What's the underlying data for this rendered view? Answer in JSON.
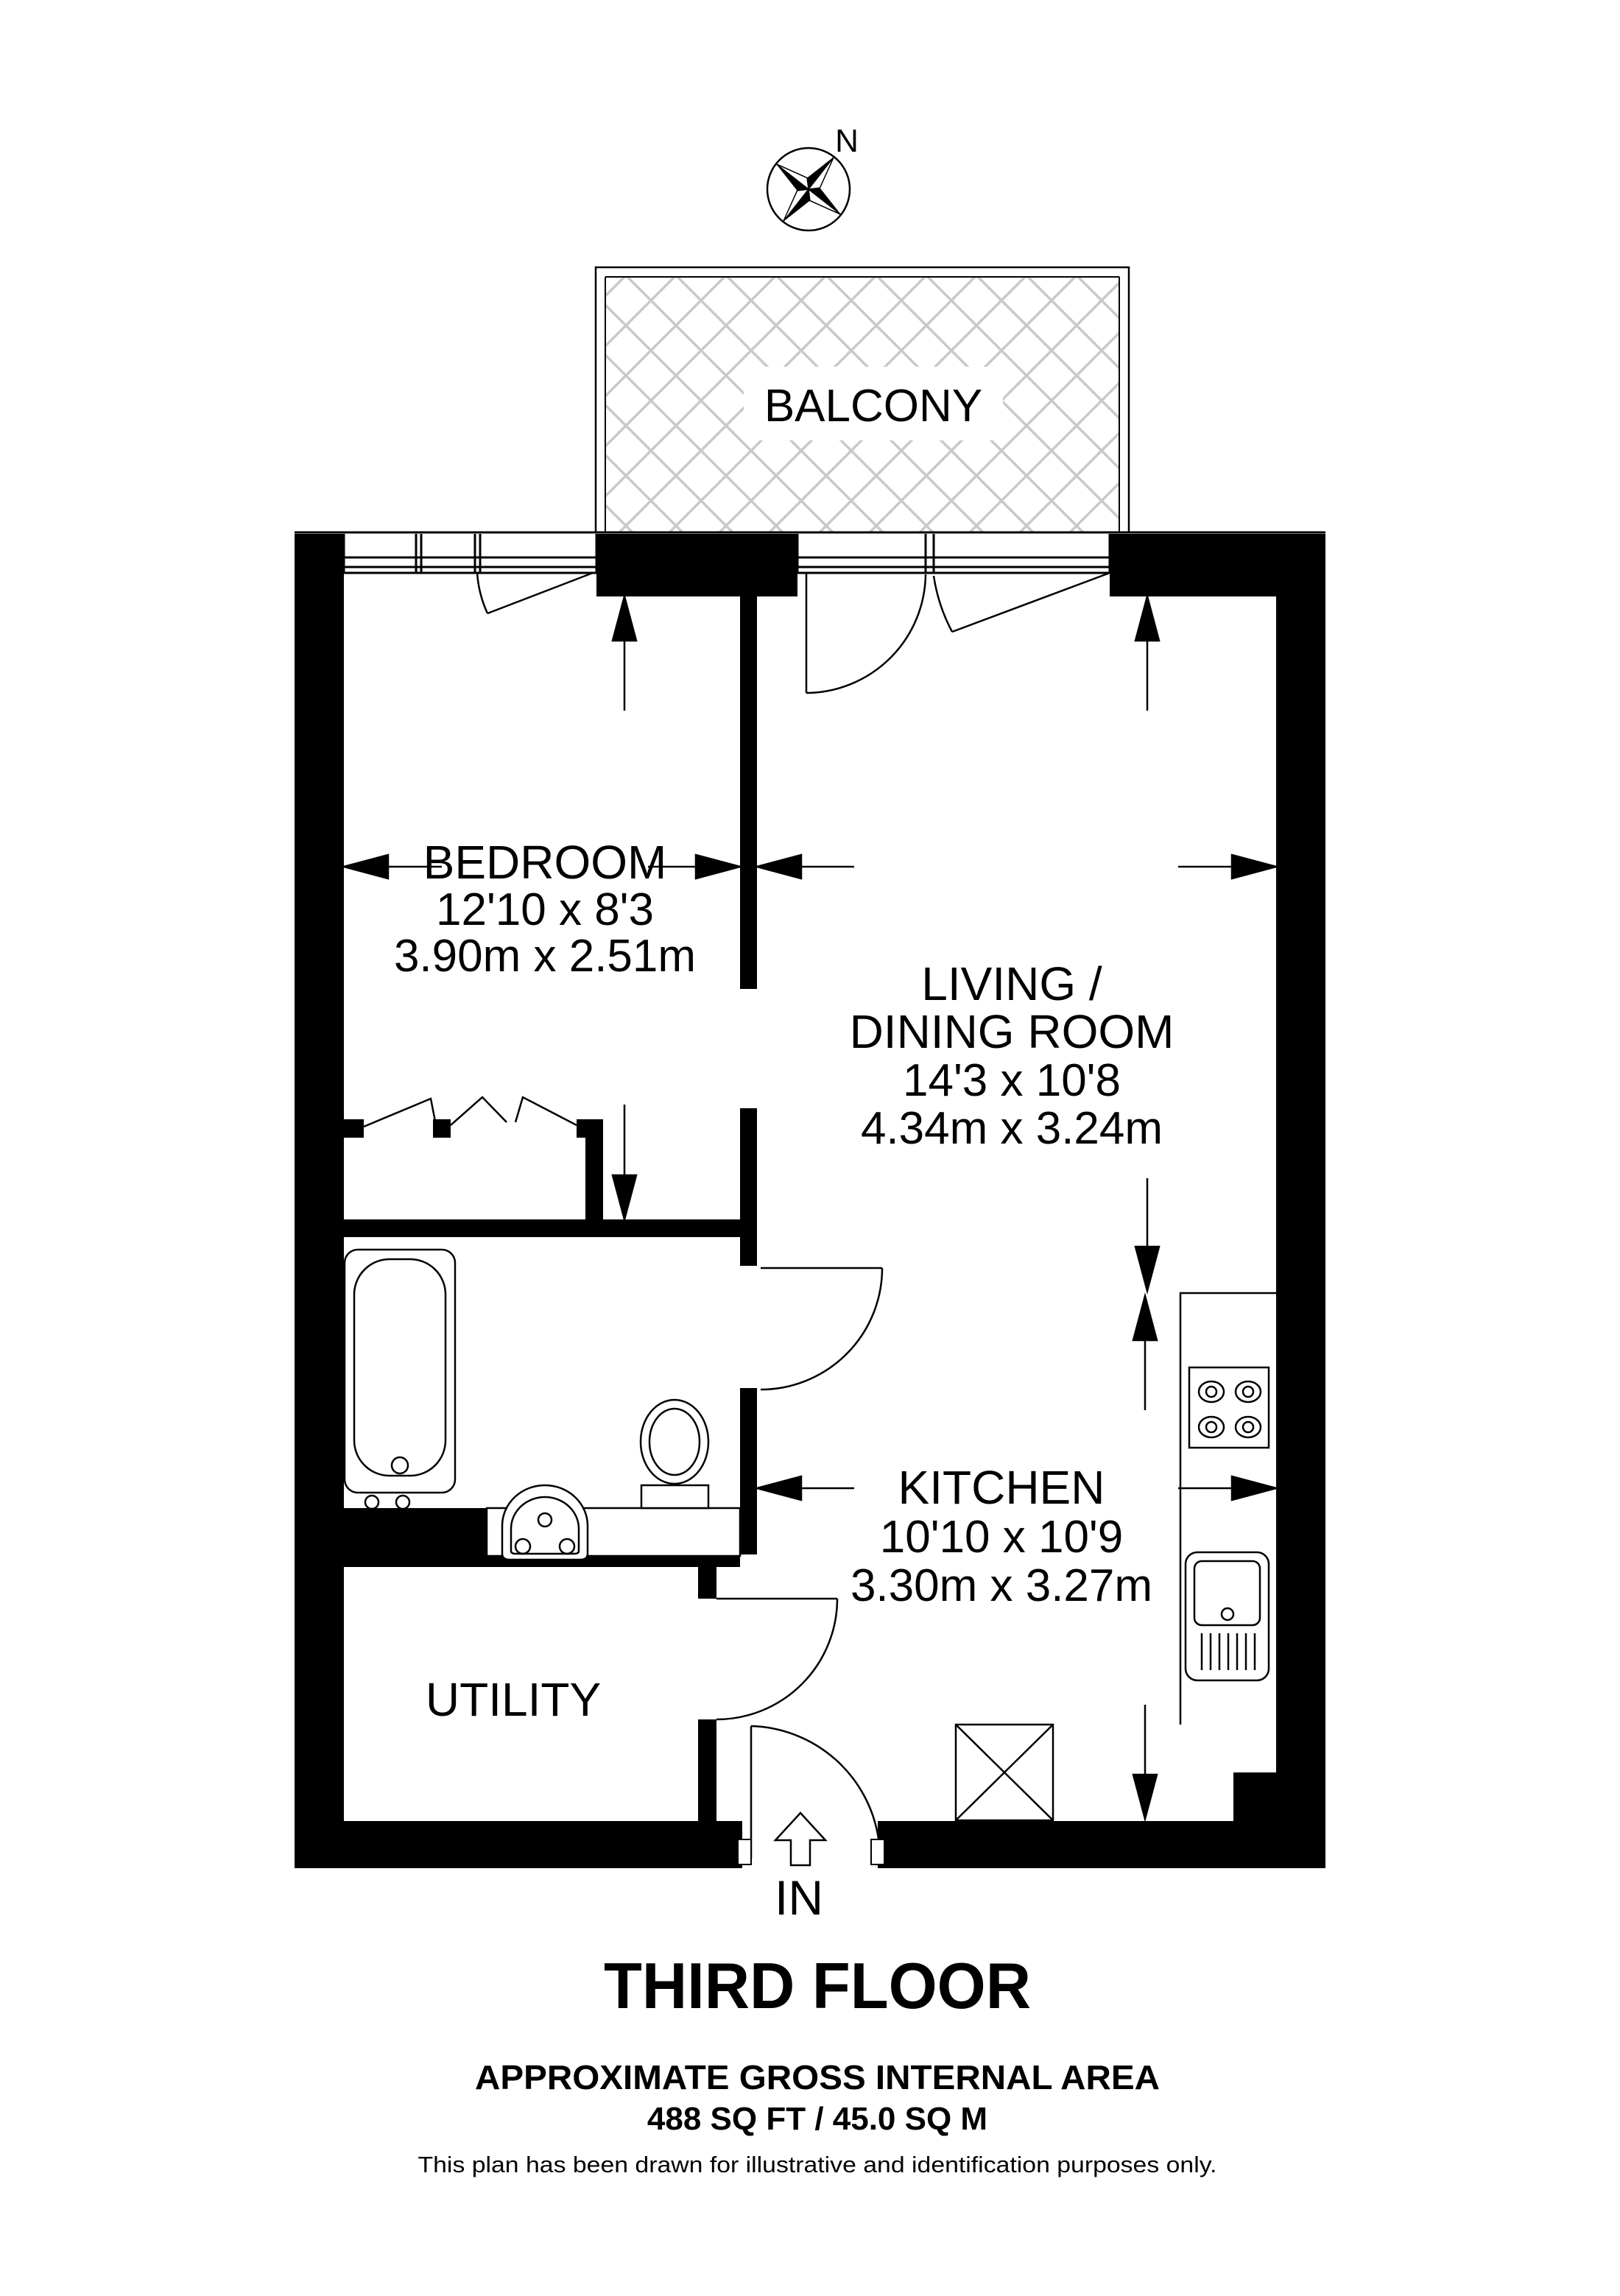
{
  "plan": {
    "compass": {
      "label": "N"
    },
    "balcony": {
      "label": "BALCONY"
    },
    "rooms": {
      "bedroom": {
        "name": "BEDROOM",
        "size_imperial": "12'10 x 8'3",
        "size_metric": "3.90m x 2.51m"
      },
      "living_dining": {
        "name_line1": "LIVING /",
        "name_line2": "DINING ROOM",
        "size_imperial": "14'3 x 10'8",
        "size_metric": "4.34m x 3.24m"
      },
      "kitchen": {
        "name": "KITCHEN",
        "size_imperial": "10'10 x 10'9",
        "size_metric": "3.30m x 3.27m"
      },
      "utility": {
        "name": "UTILITY"
      }
    },
    "entrance": {
      "label": "IN"
    }
  },
  "footer": {
    "floor_title": "THIRD FLOOR",
    "area_heading": "APPROXIMATE GROSS INTERNAL AREA",
    "area_value": "488 SQ FT / 45.0 SQ M",
    "disclaimer": "This plan has been drawn for illustrative and identification purposes only."
  },
  "colors": {
    "walls": "#000000",
    "lines": "#000000",
    "hatch": "#c9c9c9",
    "background": "#ffffff"
  }
}
